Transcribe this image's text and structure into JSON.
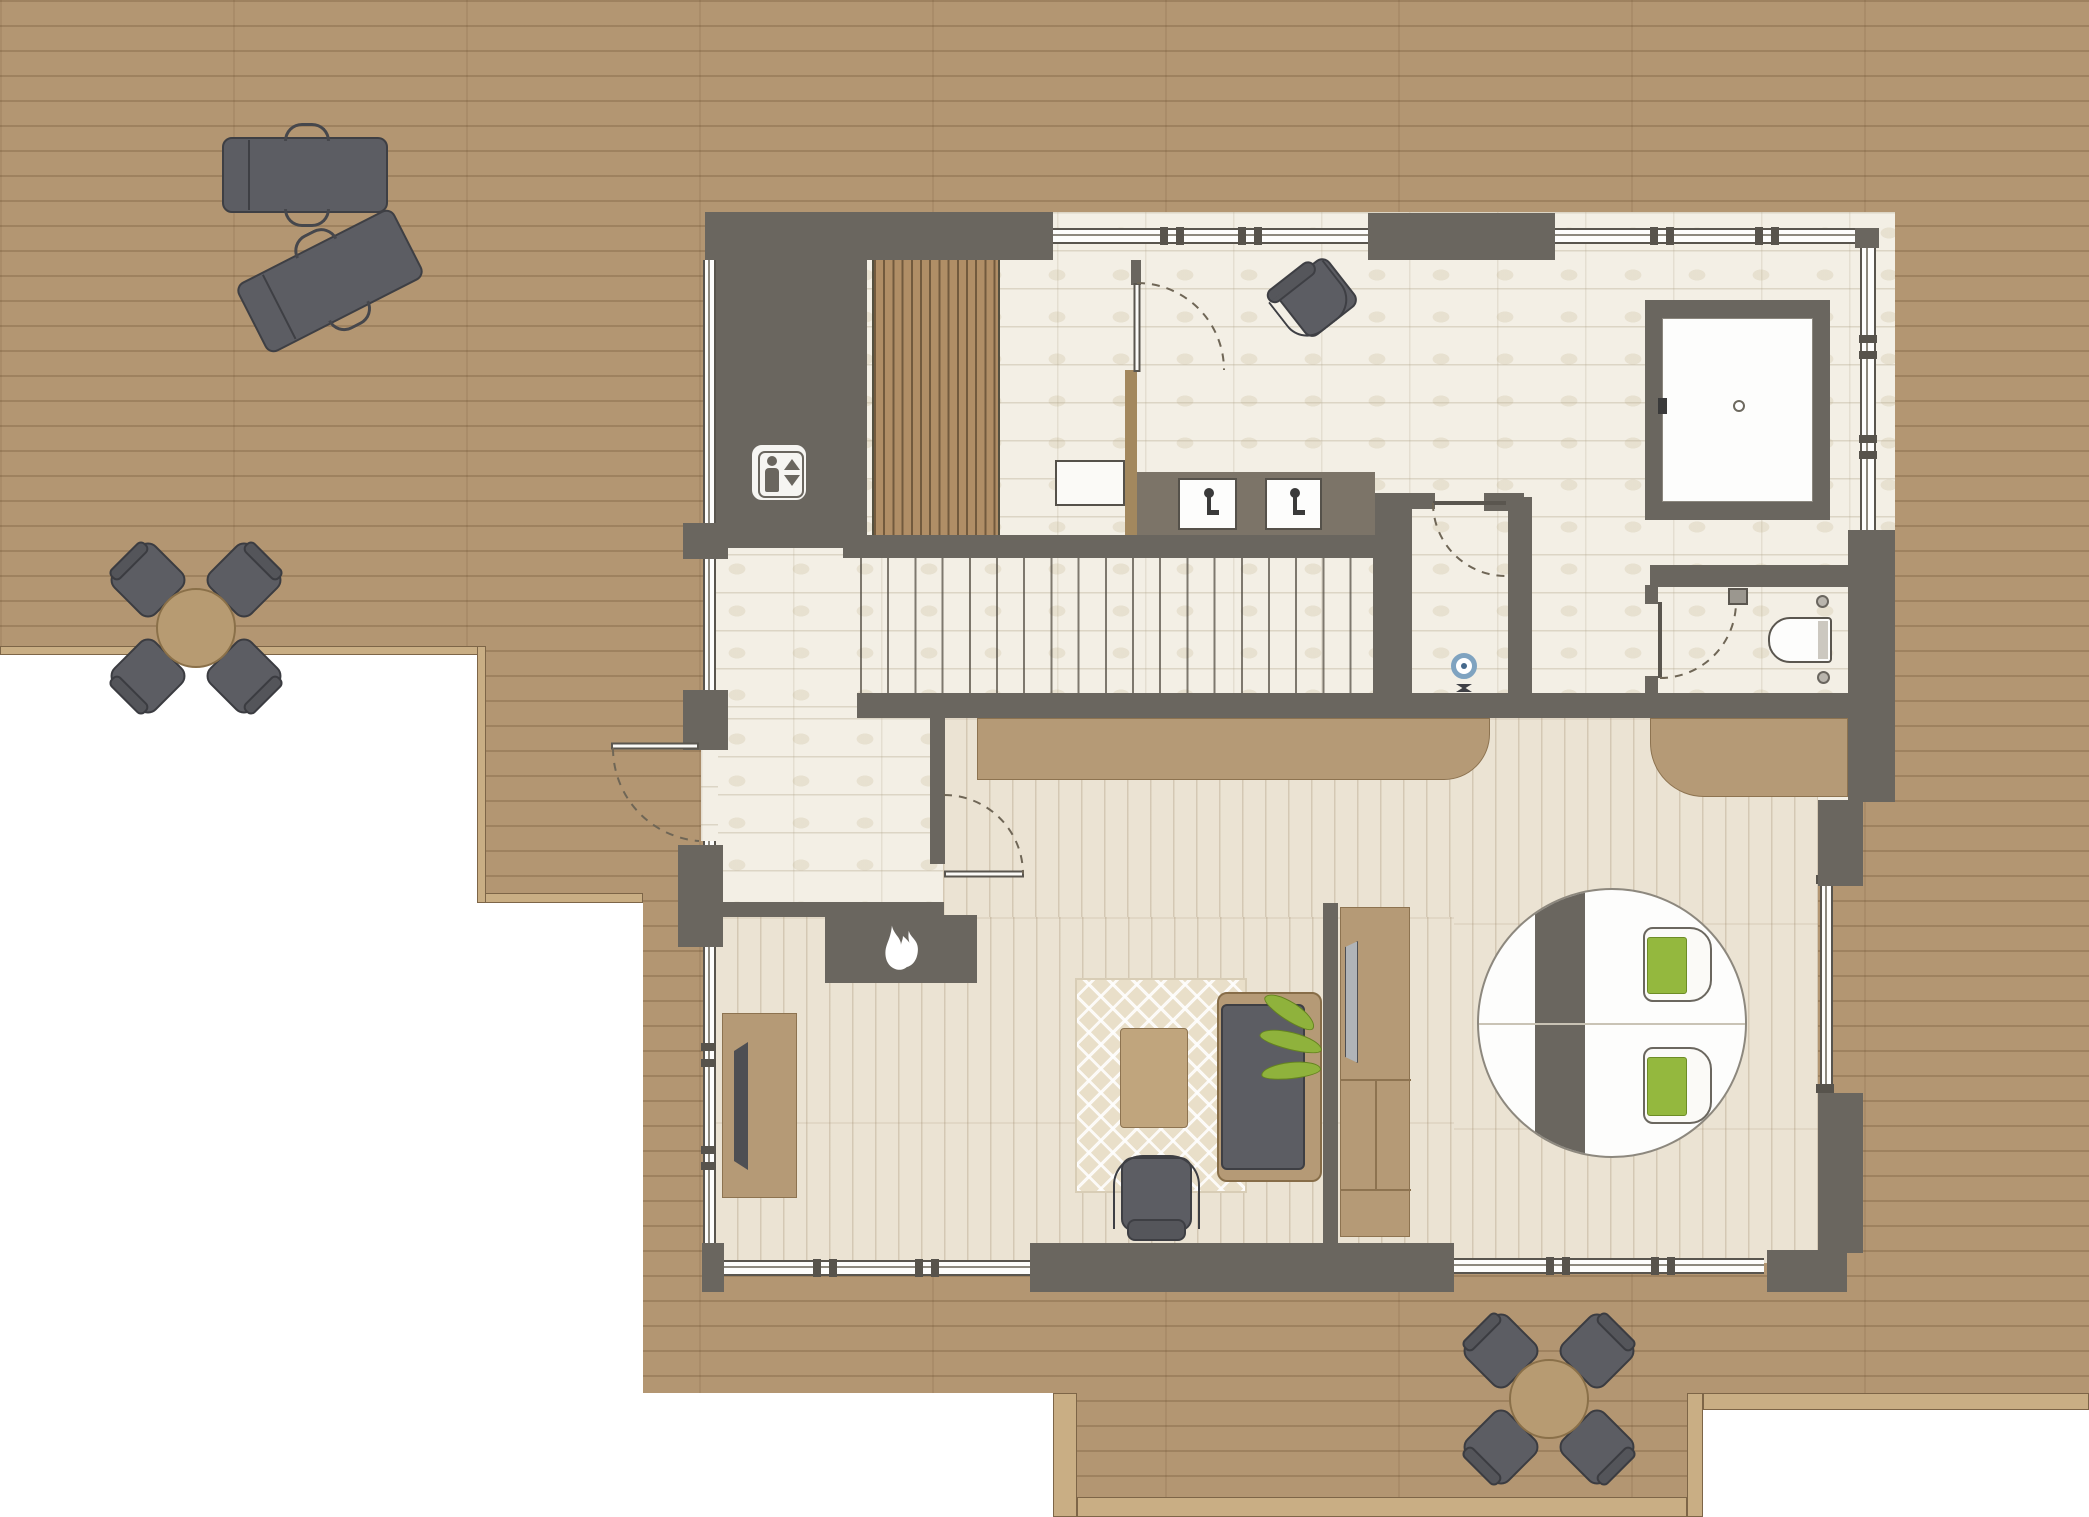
{
  "document": {
    "kind": "architectural-floor-plan",
    "canvas": {
      "width": 2089,
      "height": 1517
    },
    "text_content": "none — drawing contains no rendered text"
  },
  "palette": {
    "wall": "#6a665f",
    "deck_wood": "#b39672",
    "interior_tile": "#f3efe5",
    "interior_wood": "#ebe3d3",
    "furniture_tan": "#b59a76",
    "furniture_dark": "#5c5d63",
    "accent_green": "#8fb23c",
    "drain_blue": "#7fa3c0",
    "white_fixture": "#fbfaf7"
  },
  "icons": [
    {
      "name": "elevator-icon",
      "meaning": "elevator (person with up/down triangles)"
    },
    {
      "name": "flame-icon",
      "meaning": "fireplace"
    },
    {
      "name": "drain-icon",
      "meaning": "floor drain in shower"
    }
  ],
  "outdoor": {
    "name": "wrap-around wooden deck",
    "furniture": [
      {
        "name": "sun-lounger",
        "count": 2,
        "location": "top-left deck"
      },
      {
        "name": "round-dining-set",
        "chairs": 4,
        "location": "left deck"
      },
      {
        "name": "round-dining-set",
        "chairs": 4,
        "location": "bottom deck"
      }
    ]
  },
  "rooms": [
    {
      "name": "stair-hall",
      "features": [
        "elevator shaft with elevator-icon",
        "straight staircase of ~19 treads",
        "vertical wood-slat screen",
        "open white door leaf"
      ]
    },
    {
      "name": "bathroom-spa",
      "features": [
        "bathtub with drain",
        "double-sink vanity",
        "lounge chair",
        "hinged doors"
      ]
    },
    {
      "name": "shower-room",
      "features": [
        "floor drain",
        "hinged door"
      ]
    },
    {
      "name": "wc",
      "features": [
        "wall-hung toilet",
        "cistern box",
        "hinged door"
      ]
    },
    {
      "name": "entry-vestibule",
      "features": [
        "exterior door to deck",
        "door to living room"
      ]
    },
    {
      "name": "living-room",
      "features": [
        "fireplace",
        "patterned rug",
        "coffee table",
        "sofa with plant",
        "armchair",
        "tv-sideboard",
        "media-partition-wall with tv"
      ]
    },
    {
      "name": "bedroom-study",
      "features": [
        "round table with dark runner",
        "two green-cushion chairs",
        "built-in tan cabinets",
        "corner window walls"
      ]
    }
  ],
  "counts": {
    "interior_doors": 5,
    "exterior_doors": 1,
    "window_bands": 7,
    "sinks": 2,
    "toilets": 1,
    "bathtubs": 1
  }
}
